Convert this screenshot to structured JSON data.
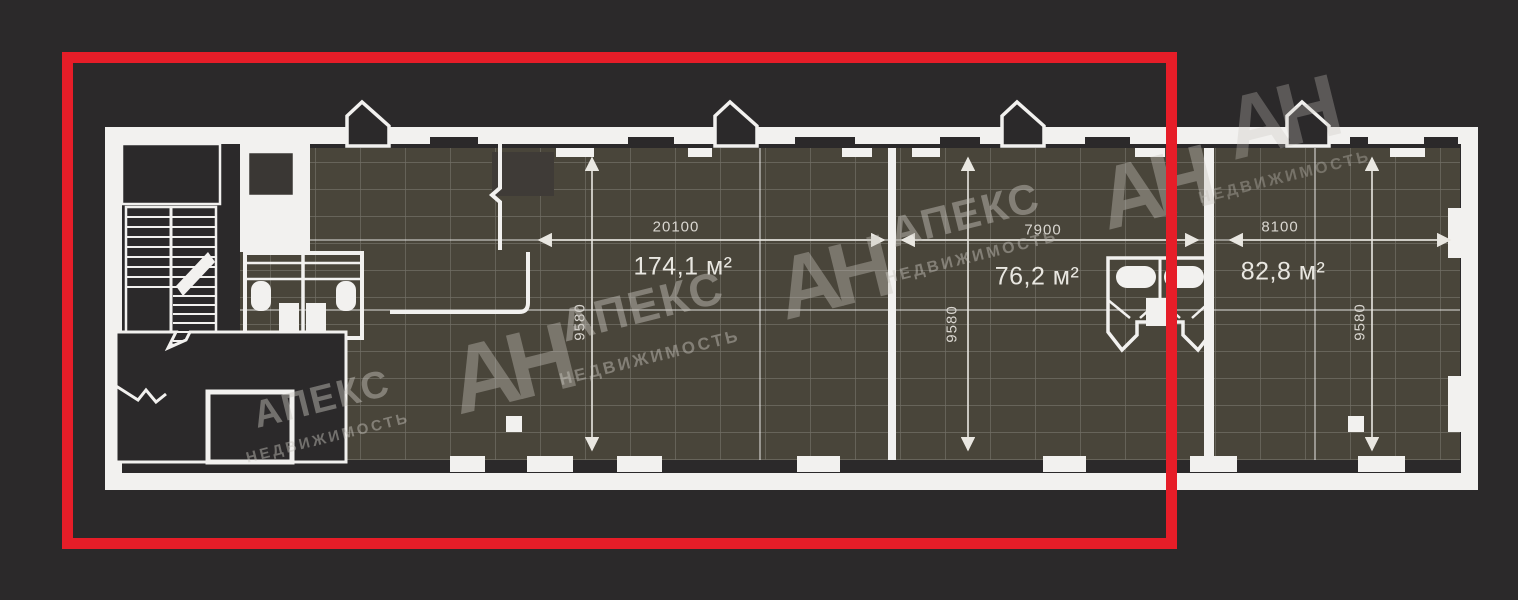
{
  "floor_plan": {
    "rooms": [
      {
        "area_label": "174,1 м²",
        "width_label": "20100",
        "depth_label": "9580"
      },
      {
        "area_label": "76,2 м²",
        "width_label": "7900",
        "depth_label": "9580"
      },
      {
        "area_label": "82,8 м²",
        "width_label": "8100",
        "depth_label": "9580"
      }
    ],
    "colors": {
      "background": "#2b292a",
      "walls": "#f2f1ef",
      "room_fill": "#49453a",
      "highlight": "#e61d28",
      "watermark": "#c9c6bf"
    }
  },
  "watermark": {
    "logo": "АН",
    "brand": "АПЕКС",
    "subtitle": "НЕДВИЖИМОСТЬ"
  }
}
